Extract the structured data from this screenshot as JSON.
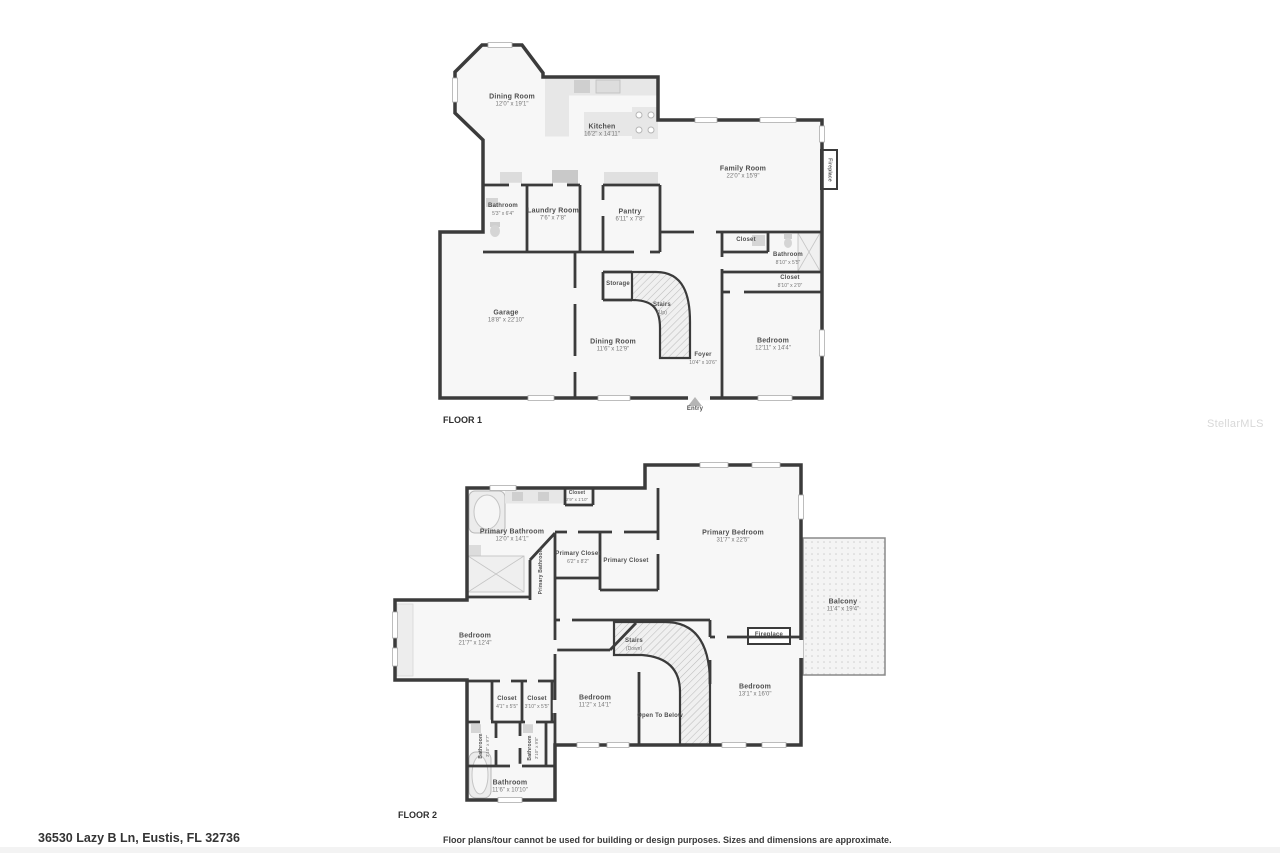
{
  "watermark": "StellarMLS",
  "footer": {
    "address": "36530 Lazy B Ln, Eustis, FL 32736",
    "disclaimer": "Floor plans/tour cannot be used for building or design purposes. Sizes and dimensions are approximate."
  },
  "colors": {
    "wall": "#3b3b3b",
    "room_fill": "#f7f7f7",
    "fixture_gray": "#e7e7e7",
    "label_text": "#4f4f4f",
    "watermark_gray": "#d8d8d8"
  },
  "floor1": {
    "title": "FLOOR 1",
    "rooms": [
      {
        "name": "Dining Room",
        "dims": "12'0\" x 19'1\""
      },
      {
        "name": "Kitchen",
        "dims": "16'2\" x 14'11\""
      },
      {
        "name": "Family Room",
        "dims": "22'0\" x 15'9\""
      },
      {
        "name": "Bathroom",
        "dims": "5'3\" x 6'4\""
      },
      {
        "name": "Laundry Room",
        "dims": "7'6\" x 7'8\""
      },
      {
        "name": "Pantry",
        "dims": "6'11\" x 7'8\""
      },
      {
        "name": "Closet"
      },
      {
        "name": "Bathroom",
        "dims": "8'10\" x 5'5\""
      },
      {
        "name": "Closet",
        "dims": "8'10\" x 2'0\""
      },
      {
        "name": "Storage"
      },
      {
        "name": "Stairs",
        "dims": "(Up)"
      },
      {
        "name": "Garage",
        "dims": "18'8\" x 22'10\""
      },
      {
        "name": "Dining Room",
        "dims": "11'6\" x 12'9\""
      },
      {
        "name": "Foyer",
        "dims": "10'4\" x 10'6\""
      },
      {
        "name": "Bedroom",
        "dims": "12'11\" x 14'4\""
      },
      {
        "name": "Entry"
      },
      {
        "name": "Fireplace"
      }
    ]
  },
  "floor2": {
    "title": "FLOOR 2",
    "rooms": [
      {
        "name": "Closet",
        "dims": "2'9\" x 1'10\""
      },
      {
        "name": "Primary Bathroom",
        "dims": "12'0\" x 14'1\""
      },
      {
        "name": "Primary Closet",
        "dims": "6'2\" x 8'2\""
      },
      {
        "name": "Primary Closet"
      },
      {
        "name": "Primary Bathroom"
      },
      {
        "name": "Primary Bedroom",
        "dims": "31'7\" x 22'5\""
      },
      {
        "name": "Balcony",
        "dims": "11'4\" x 19'4\""
      },
      {
        "name": "Bedroom",
        "dims": "21'7\" x 12'4\""
      },
      {
        "name": "Stairs",
        "dims": "(Down)"
      },
      {
        "name": "Fireplace"
      },
      {
        "name": "Bedroom",
        "dims": "13'1\" x 16'0\""
      },
      {
        "name": "Closet",
        "dims": "4'1\" x 5'5\""
      },
      {
        "name": "Closet",
        "dims": "3'10\" x 5'5\""
      },
      {
        "name": "Bedroom",
        "dims": "11'2\" x 14'1\""
      },
      {
        "name": "Open To Below"
      },
      {
        "name": "Bathroom",
        "dims": "3'10\" x 9'7\""
      },
      {
        "name": "Bathroom",
        "dims": "3'10\" x 9'8\""
      },
      {
        "name": "Bathroom",
        "dims": "11'6\" x 10'10\""
      }
    ]
  }
}
